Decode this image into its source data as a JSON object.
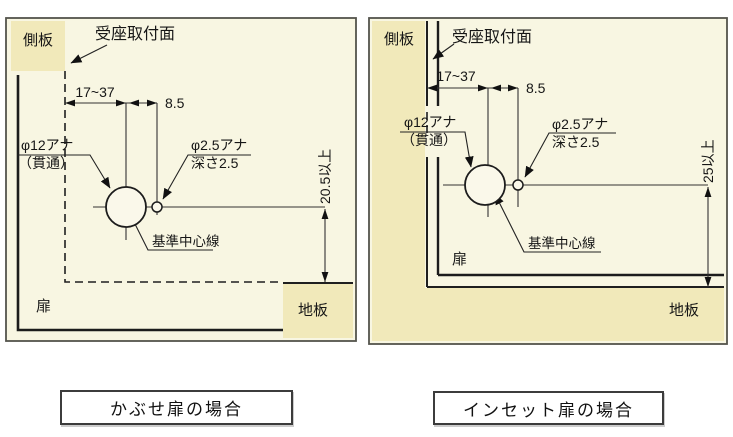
{
  "page": {
    "background": "#ffffff"
  },
  "colors": {
    "panel_background": "#f8f6e2",
    "board_fill": "#f1e9ba",
    "line": "#1f1f1f",
    "panel_border": "#54544c",
    "caption_border": "#3c3c3c",
    "caption_background": "#ffffff"
  },
  "panels": [
    {
      "caption": "かぶせ扉の場合",
      "labels": {
        "side_board": "側板",
        "mounting_face": "受座取付面",
        "dim_width": "17~37",
        "dim_offset": "8.5",
        "hole_large_line1": "φ12アナ",
        "hole_large_line2": "（貫通）",
        "hole_small_line1": "φ2.5アナ",
        "hole_small_line2": "深さ2.5",
        "center_line": "基準中心線",
        "dim_vertical": "20.5以上",
        "door": "扉",
        "bottom_board": "地板"
      }
    },
    {
      "caption": "インセット扉の場合",
      "labels": {
        "side_board": "側板",
        "mounting_face": "受座取付面",
        "dim_width": "17~37",
        "dim_offset": "8.5",
        "hole_large_line1": "φ12アナ",
        "hole_large_line2": "（貫通）",
        "hole_small_line1": "φ2.5アナ",
        "hole_small_line2": "深さ2.5",
        "center_line": "基準中心線",
        "dim_vertical": "25以上",
        "door": "扉",
        "bottom_board": "地板"
      }
    }
  ]
}
